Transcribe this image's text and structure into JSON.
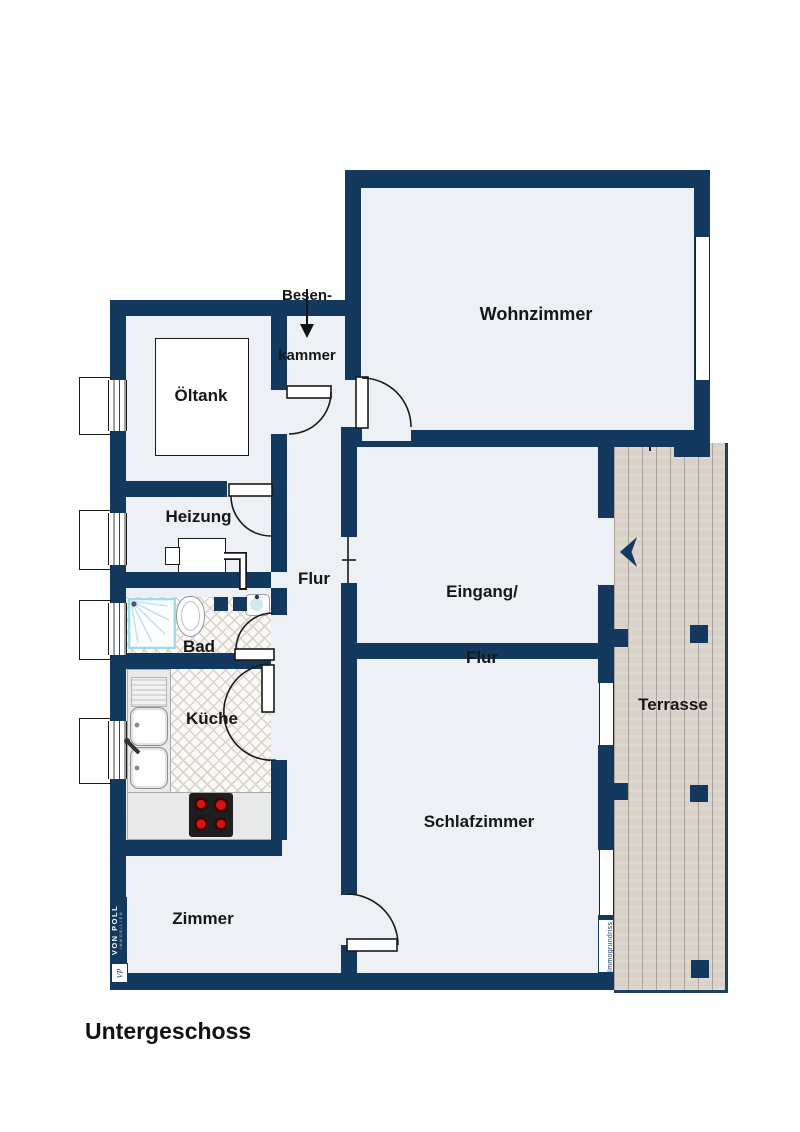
{
  "plan": {
    "floor_title": "Untergeschoss",
    "labels": {
      "wohnzimmer": "Wohnzimmer",
      "besenkammer_line1": "Besen-",
      "besenkammer_line2": "kammer",
      "oeltank": "Öltank",
      "heizung": "Heizung",
      "flur": "Flur",
      "eingang_line1": "Eingang/",
      "eingang_line2": "Flur",
      "bad": "Bad",
      "kueche": "Küche",
      "schlafzimmer": "Schlafzimmer",
      "zimmer": "Zimmer",
      "terrasse": "Terrasse"
    },
    "branding": {
      "logo_primary": "VON POLL",
      "logo_secondary": "IMMOBILIEN",
      "logo_monogram": "VP",
      "provider": "Immogrundriss"
    },
    "colors": {
      "wall": "#14395f",
      "floor": "#edf1f6",
      "background": "#ffffff",
      "terrace_wood": "#d9d2ca",
      "terrace_plank_line": "#aba29a",
      "tile_line": "#d8d3cb",
      "label_text": "#161616",
      "burner_red": "#cc1111",
      "shower_blue": "#9fdbe9"
    },
    "icons": [
      "oil-tank-icon",
      "heater-icon",
      "shower-icon",
      "toilet-icon",
      "washbasin-icon",
      "kitchen-sink-icon",
      "stove-icon",
      "entrance-arrow-icon",
      "besenkammer-arrow-icon"
    ]
  }
}
